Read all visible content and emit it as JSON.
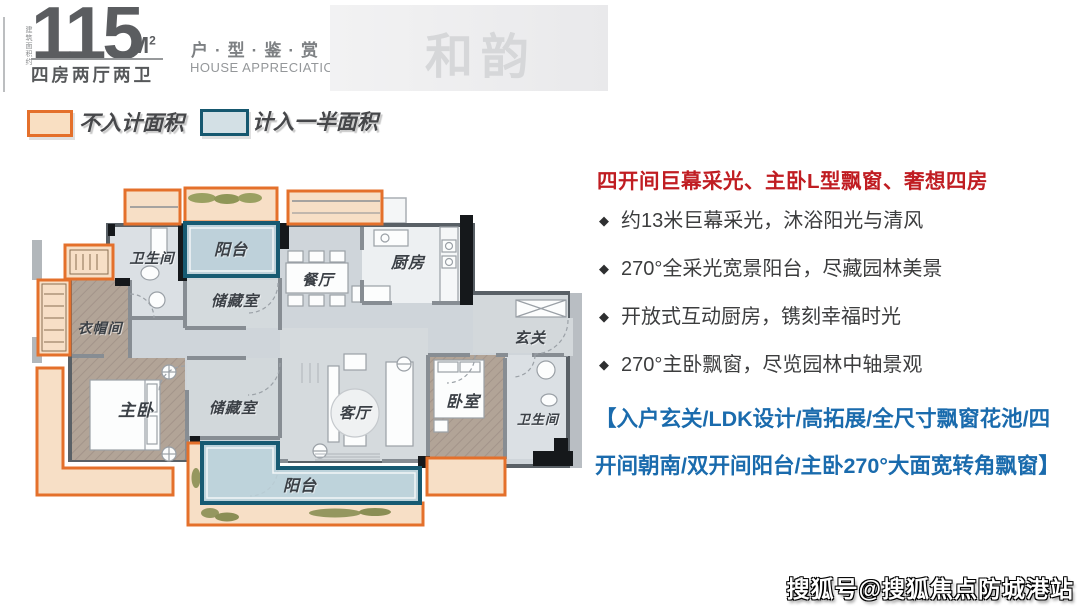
{
  "header": {
    "area_note": "建筑面积约",
    "area_value": "115",
    "area_unit": "M",
    "area_unit_sup": "2",
    "layout_label": "四房两厅两卫",
    "series_cn": "户·型·鉴·赏",
    "series_en": "HOUSE APPRECIATION",
    "watermark": "和韵"
  },
  "legend": {
    "orange_label": "不入计面积",
    "blue_label": "计入一半面积"
  },
  "plan": {
    "rooms": {
      "bath1": "卫生间",
      "balcony_top": "阳台",
      "storage1": "储藏室",
      "dining": "餐厅",
      "kitchen": "厨房",
      "cloak": "衣帽间",
      "foyer": "玄关",
      "master": "主卧",
      "storage2": "储藏室",
      "living": "客厅",
      "bed2": "卧室",
      "bath2": "卫生间",
      "balcony_bottom": "阳台"
    }
  },
  "highlights": {
    "headline": "四开间巨幕采光、主卧L型飘窗、奢想四房",
    "marker": "◆",
    "bullets": [
      "约13米巨幕采光，沐浴阳光与清风",
      "270°全采光宽景阳台，尽藏园林美景",
      "开放式互动厨房，镌刻幸福时光",
      "270°主卧飘窗，尽览园林中轴景观"
    ],
    "summary": "【入户玄关/LDK设计/高拓展/全尺寸飘窗花池/四开间朝南/双开间阳台/主卧270°大面宽转角飘窗】"
  },
  "footer": {
    "credit": "搜狐号@搜狐焦点防城港站"
  },
  "colors": {
    "accent_orange": "#e4702b",
    "accent_orange_fill": "#f7dfc6",
    "accent_blue": "#175a72",
    "accent_blue_fill": "#c3d4db",
    "headline_red": "#c01d22",
    "summary_blue": "#1a6bad"
  }
}
